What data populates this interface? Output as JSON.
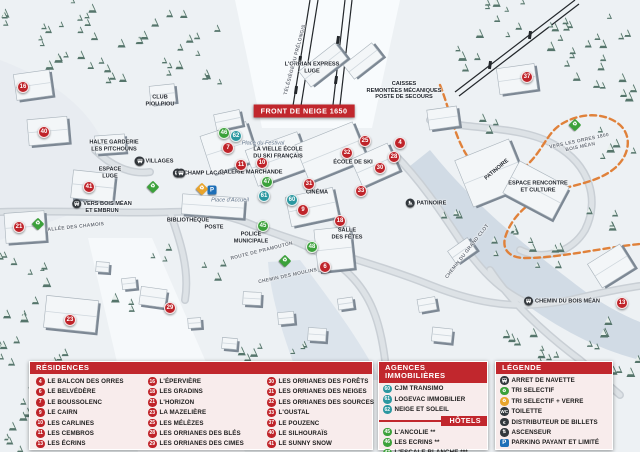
{
  "colors": {
    "accent_red": "#c1272d",
    "marker_residence": "#bf2329",
    "marker_hotel": "#3ba13a",
    "marker_agence": "#2b97a0",
    "legend_bg": "#f8ecec",
    "trail_orange": "#e0813a",
    "parking_blue": "#1d6fb8"
  },
  "map": {
    "banner": {
      "text": "FRONT DE NEIGE 1650"
    },
    "labels": [
      {
        "lines": [
          "L'ORRIAN EXPRESS",
          "LUGE"
        ],
        "x": 312,
        "y": 68,
        "rot": 0,
        "variant": "dark"
      },
      {
        "lines": [
          "TÉLÉSIÈGE DU PRÉLONGIS"
        ],
        "x": 296,
        "y": 60,
        "rot": -75,
        "variant": "road"
      },
      {
        "lines": [
          "CAISSES",
          "REMONTÉES MÉCANIQUES",
          "POSTE DE SECOURS"
        ],
        "x": 404,
        "y": 91,
        "rot": 0,
        "variant": "dark"
      },
      {
        "lines": [
          "CLUB",
          "PIOU PIOU"
        ],
        "x": 160,
        "y": 101,
        "rot": 0,
        "variant": "dark"
      },
      {
        "lines": [
          "HALTE GARDERIE",
          "LES PITCHOUNS"
        ],
        "x": 114,
        "y": 146,
        "rot": 0,
        "variant": "dark"
      },
      {
        "lines": [
          "ESPACE",
          "LUGE"
        ],
        "x": 110,
        "y": 173,
        "rot": 0,
        "variant": "dark"
      },
      {
        "lines": [
          "VILLAGES"
        ],
        "x": 154,
        "y": 161,
        "rot": 0,
        "variant": "dark",
        "icon": "bus-icon"
      },
      {
        "lines": [
          "CHAMP LACAS"
        ],
        "x": 199,
        "y": 173,
        "rot": 0,
        "variant": "dark",
        "icon": "bus-icon"
      },
      {
        "lines": [
          "LA VIELLE ÉCOLE",
          "DU SKI FRANÇAIS"
        ],
        "x": 278,
        "y": 153,
        "rot": 0,
        "variant": "dark"
      },
      {
        "lines": [
          "Place du Festival"
        ],
        "x": 263,
        "y": 144,
        "rot": 0,
        "variant": "italic"
      },
      {
        "lines": [
          "GALERIE MARCHANDE"
        ],
        "x": 251,
        "y": 173,
        "rot": 0,
        "variant": "dark"
      },
      {
        "lines": [
          "ÉCOLE DE SKI"
        ],
        "x": 353,
        "y": 163,
        "rot": 0,
        "variant": "dark"
      },
      {
        "lines": [
          "CINÉMA"
        ],
        "x": 317,
        "y": 193,
        "rot": 0,
        "variant": "dark"
      },
      {
        "lines": [
          "Place d'Accueil"
        ],
        "x": 230,
        "y": 201,
        "rot": 0,
        "variant": "italic"
      },
      {
        "lines": [
          "BIBLIOTHÈQUE"
        ],
        "x": 188,
        "y": 221,
        "rot": 0,
        "variant": "dark"
      },
      {
        "lines": [
          "POSTE"
        ],
        "x": 214,
        "y": 228,
        "rot": 0,
        "variant": "dark"
      },
      {
        "lines": [
          "POLICE",
          "MUNICIPALE"
        ],
        "x": 251,
        "y": 238,
        "rot": 0,
        "variant": "dark"
      },
      {
        "lines": [
          "SALLE",
          "DES FÊTES"
        ],
        "x": 347,
        "y": 234,
        "rot": 0,
        "variant": "dark"
      },
      {
        "lines": [
          "PATINOIRE"
        ],
        "x": 426,
        "y": 203,
        "rot": 0,
        "variant": "dark",
        "icon": "skate-icon"
      },
      {
        "lines": [
          "PATINOIRE"
        ],
        "x": 497,
        "y": 170,
        "rot": -40,
        "variant": "dark"
      },
      {
        "lines": [
          "ESPACE RENCONTRE",
          "ET CULTURE"
        ],
        "x": 538,
        "y": 187,
        "rot": 0,
        "variant": "dark"
      },
      {
        "lines": [
          "VERS BOIS MÉAN",
          "ET EMBRUN"
        ],
        "x": 102,
        "y": 207,
        "rot": 0,
        "variant": "dark",
        "icon": "bus-icon"
      },
      {
        "lines": [
          "CHEMIN DU BOIS MÉAN"
        ],
        "x": 562,
        "y": 301,
        "rot": 0,
        "variant": "dark",
        "icon": "bus-icon"
      },
      {
        "lines": [
          "ALLÉE DES CHAMOIS"
        ],
        "x": 76,
        "y": 228,
        "rot": -6,
        "variant": "road"
      },
      {
        "lines": [
          "ROUTE DE PRAMOUTON"
        ],
        "x": 262,
        "y": 252,
        "rot": -14,
        "variant": "road"
      },
      {
        "lines": [
          "CHEMIN DES MOULINS"
        ],
        "x": 288,
        "y": 277,
        "rot": -12,
        "variant": "road"
      },
      {
        "lines": [
          "CHEMIN DU GRAND CLOT"
        ],
        "x": 468,
        "y": 252,
        "rot": -52,
        "variant": "road"
      },
      {
        "lines": [
          "VERS LES ORRES 1800",
          "BOIS MÉAN"
        ],
        "x": 580,
        "y": 145,
        "rot": -12,
        "variant": "road"
      }
    ],
    "markers": [
      {
        "num": "16",
        "x": 23,
        "y": 87,
        "type": "residence"
      },
      {
        "num": "40",
        "x": 44,
        "y": 132,
        "type": "residence"
      },
      {
        "num": "41",
        "x": 89,
        "y": 187,
        "type": "residence"
      },
      {
        "num": "21",
        "x": 19,
        "y": 227,
        "type": "residence"
      },
      {
        "num": "23",
        "x": 70,
        "y": 320,
        "type": "residence"
      },
      {
        "num": "29",
        "x": 170,
        "y": 308,
        "type": "residence"
      },
      {
        "num": "7",
        "x": 228,
        "y": 148,
        "type": "residence"
      },
      {
        "num": "11",
        "x": 241,
        "y": 165,
        "type": "residence"
      },
      {
        "num": "10",
        "x": 262,
        "y": 163,
        "type": "residence"
      },
      {
        "num": "25",
        "x": 365,
        "y": 141,
        "type": "residence"
      },
      {
        "num": "4",
        "x": 400,
        "y": 143,
        "type": "residence"
      },
      {
        "num": "32",
        "x": 347,
        "y": 153,
        "type": "residence"
      },
      {
        "num": "28",
        "x": 394,
        "y": 157,
        "type": "residence"
      },
      {
        "num": "30",
        "x": 380,
        "y": 168,
        "type": "residence"
      },
      {
        "num": "31",
        "x": 309,
        "y": 184,
        "type": "residence"
      },
      {
        "num": "33",
        "x": 361,
        "y": 191,
        "type": "residence"
      },
      {
        "num": "9",
        "x": 303,
        "y": 210,
        "type": "residence"
      },
      {
        "num": "18",
        "x": 340,
        "y": 221,
        "type": "residence"
      },
      {
        "num": "6",
        "x": 325,
        "y": 267,
        "type": "residence"
      },
      {
        "num": "37",
        "x": 527,
        "y": 77,
        "type": "residence"
      },
      {
        "num": "13",
        "x": 622,
        "y": 303,
        "type": "residence"
      },
      {
        "num": "46",
        "x": 224,
        "y": 133,
        "type": "hotel"
      },
      {
        "num": "47",
        "x": 267,
        "y": 182,
        "type": "hotel"
      },
      {
        "num": "45",
        "x": 263,
        "y": 226,
        "type": "hotel"
      },
      {
        "num": "48",
        "x": 312,
        "y": 247,
        "type": "hotel"
      },
      {
        "num": "60",
        "x": 292,
        "y": 200,
        "type": "agence"
      },
      {
        "num": "61",
        "x": 264,
        "y": 196,
        "type": "agence"
      },
      {
        "num": "62",
        "x": 236,
        "y": 136,
        "type": "agence"
      }
    ],
    "pois": [
      {
        "icon": "bus-icon",
        "x": 140,
        "y": 161,
        "kind": "bus"
      },
      {
        "icon": "bus-icon",
        "x": 181,
        "y": 173,
        "kind": "bus"
      },
      {
        "icon": "parking-icon",
        "x": 212,
        "y": 190,
        "kind": "parking",
        "glyph": "P"
      },
      {
        "icon": "recycle-yellow-icon",
        "x": 202,
        "y": 189,
        "kind": "diamond yellow",
        "glyph": "♻"
      },
      {
        "icon": "recycle-green-icon",
        "x": 153,
        "y": 187,
        "kind": "diamond green",
        "glyph": "♻"
      },
      {
        "icon": "recycle-green-icon",
        "x": 38,
        "y": 224,
        "kind": "diamond green",
        "glyph": "♻"
      },
      {
        "icon": "recycle-green-icon",
        "x": 285,
        "y": 261,
        "kind": "diamond green",
        "glyph": "♻"
      },
      {
        "icon": "recycle-green-icon",
        "x": 575,
        "y": 125,
        "kind": "diamond green",
        "glyph": "♻"
      }
    ]
  },
  "legend": {
    "residences": {
      "title": "RÉSIDENCES",
      "columns": [
        [
          {
            "num": "4",
            "label": "LE BALCON DES ORRES"
          },
          {
            "num": "6",
            "label": "LE BELVÉDÈRE"
          },
          {
            "num": "7",
            "label": "LE BOUSSOLENC"
          },
          {
            "num": "9",
            "label": "LE CAIRN"
          },
          {
            "num": "10",
            "label": "LES CARLINES"
          },
          {
            "num": "11",
            "label": "LES CEMBROS"
          },
          {
            "num": "13",
            "label": "LES ÉCRINS"
          }
        ],
        [
          {
            "num": "16",
            "label": "L'ÉPERVIÈRE"
          },
          {
            "num": "18",
            "label": "LES GRADINS"
          },
          {
            "num": "21",
            "label": "L'HORIZON"
          },
          {
            "num": "23",
            "label": "LA MAZELIÈRE"
          },
          {
            "num": "25",
            "label": "LES MÉLÈZES"
          },
          {
            "num": "28",
            "label": "LES ORRIANES DES BLÉS"
          },
          {
            "num": "29",
            "label": "LES ORRIANES DES CIMES"
          }
        ],
        [
          {
            "num": "30",
            "label": "LES ORRIANES DES FORÊTS"
          },
          {
            "num": "31",
            "label": "LES ORRIANES DES NEIGES"
          },
          {
            "num": "32",
            "label": "LES ORRIANES DES SOURCES"
          },
          {
            "num": "33",
            "label": "L'OUSTAL"
          },
          {
            "num": "37",
            "label": "LE POUZENC"
          },
          {
            "num": "40",
            "label": "LE SILHOURAÏS"
          },
          {
            "num": "41",
            "label": "LE SUNNY SNOW"
          }
        ]
      ]
    },
    "agences": {
      "title": "AGENCES IMMOBILIÈRES",
      "items": [
        {
          "num": "60",
          "label": "CJM TRANSIMO"
        },
        {
          "num": "61",
          "label": "LOGEVAC IMMOBILIER"
        },
        {
          "num": "62",
          "label": "NEIGE ET SOLEIL"
        }
      ]
    },
    "hotels": {
      "title": "HÔTELS",
      "items": [
        {
          "num": "45",
          "label": "L'ANCOLIE **"
        },
        {
          "num": "46",
          "label": "LES ECRINS **"
        },
        {
          "num": "47",
          "label": "L'ESCALE BLANCHE ***"
        },
        {
          "num": "48",
          "label": "LES TRAPPEURS **"
        }
      ]
    },
    "legende": {
      "title": "LÉGENDE",
      "items": [
        {
          "icon": "bus-icon",
          "style": "dark",
          "glyph": "",
          "label": "ARRET DE NAVETTE"
        },
        {
          "icon": "recycle-green-icon",
          "style": "green",
          "glyph": "♻",
          "label": "TRI SELECTIF"
        },
        {
          "icon": "recycle-glass-icon",
          "style": "yellow",
          "glyph": "♻",
          "label": "TRI SELECTIF + VERRE"
        },
        {
          "icon": "wc-icon",
          "style": "dark",
          "glyph": "WC",
          "label": "TOILETTE"
        },
        {
          "icon": "euro-icon",
          "style": "dark",
          "glyph": "€",
          "label": "DISTRIBUTEUR DE BILLETS"
        },
        {
          "icon": "elevator-icon",
          "style": "dark",
          "glyph": "⇅",
          "label": "ASCENSEUR"
        },
        {
          "icon": "parking-icon",
          "style": "blue",
          "glyph": "P",
          "label": "PARKING PAYANT ET LIMITÉ"
        }
      ]
    }
  }
}
